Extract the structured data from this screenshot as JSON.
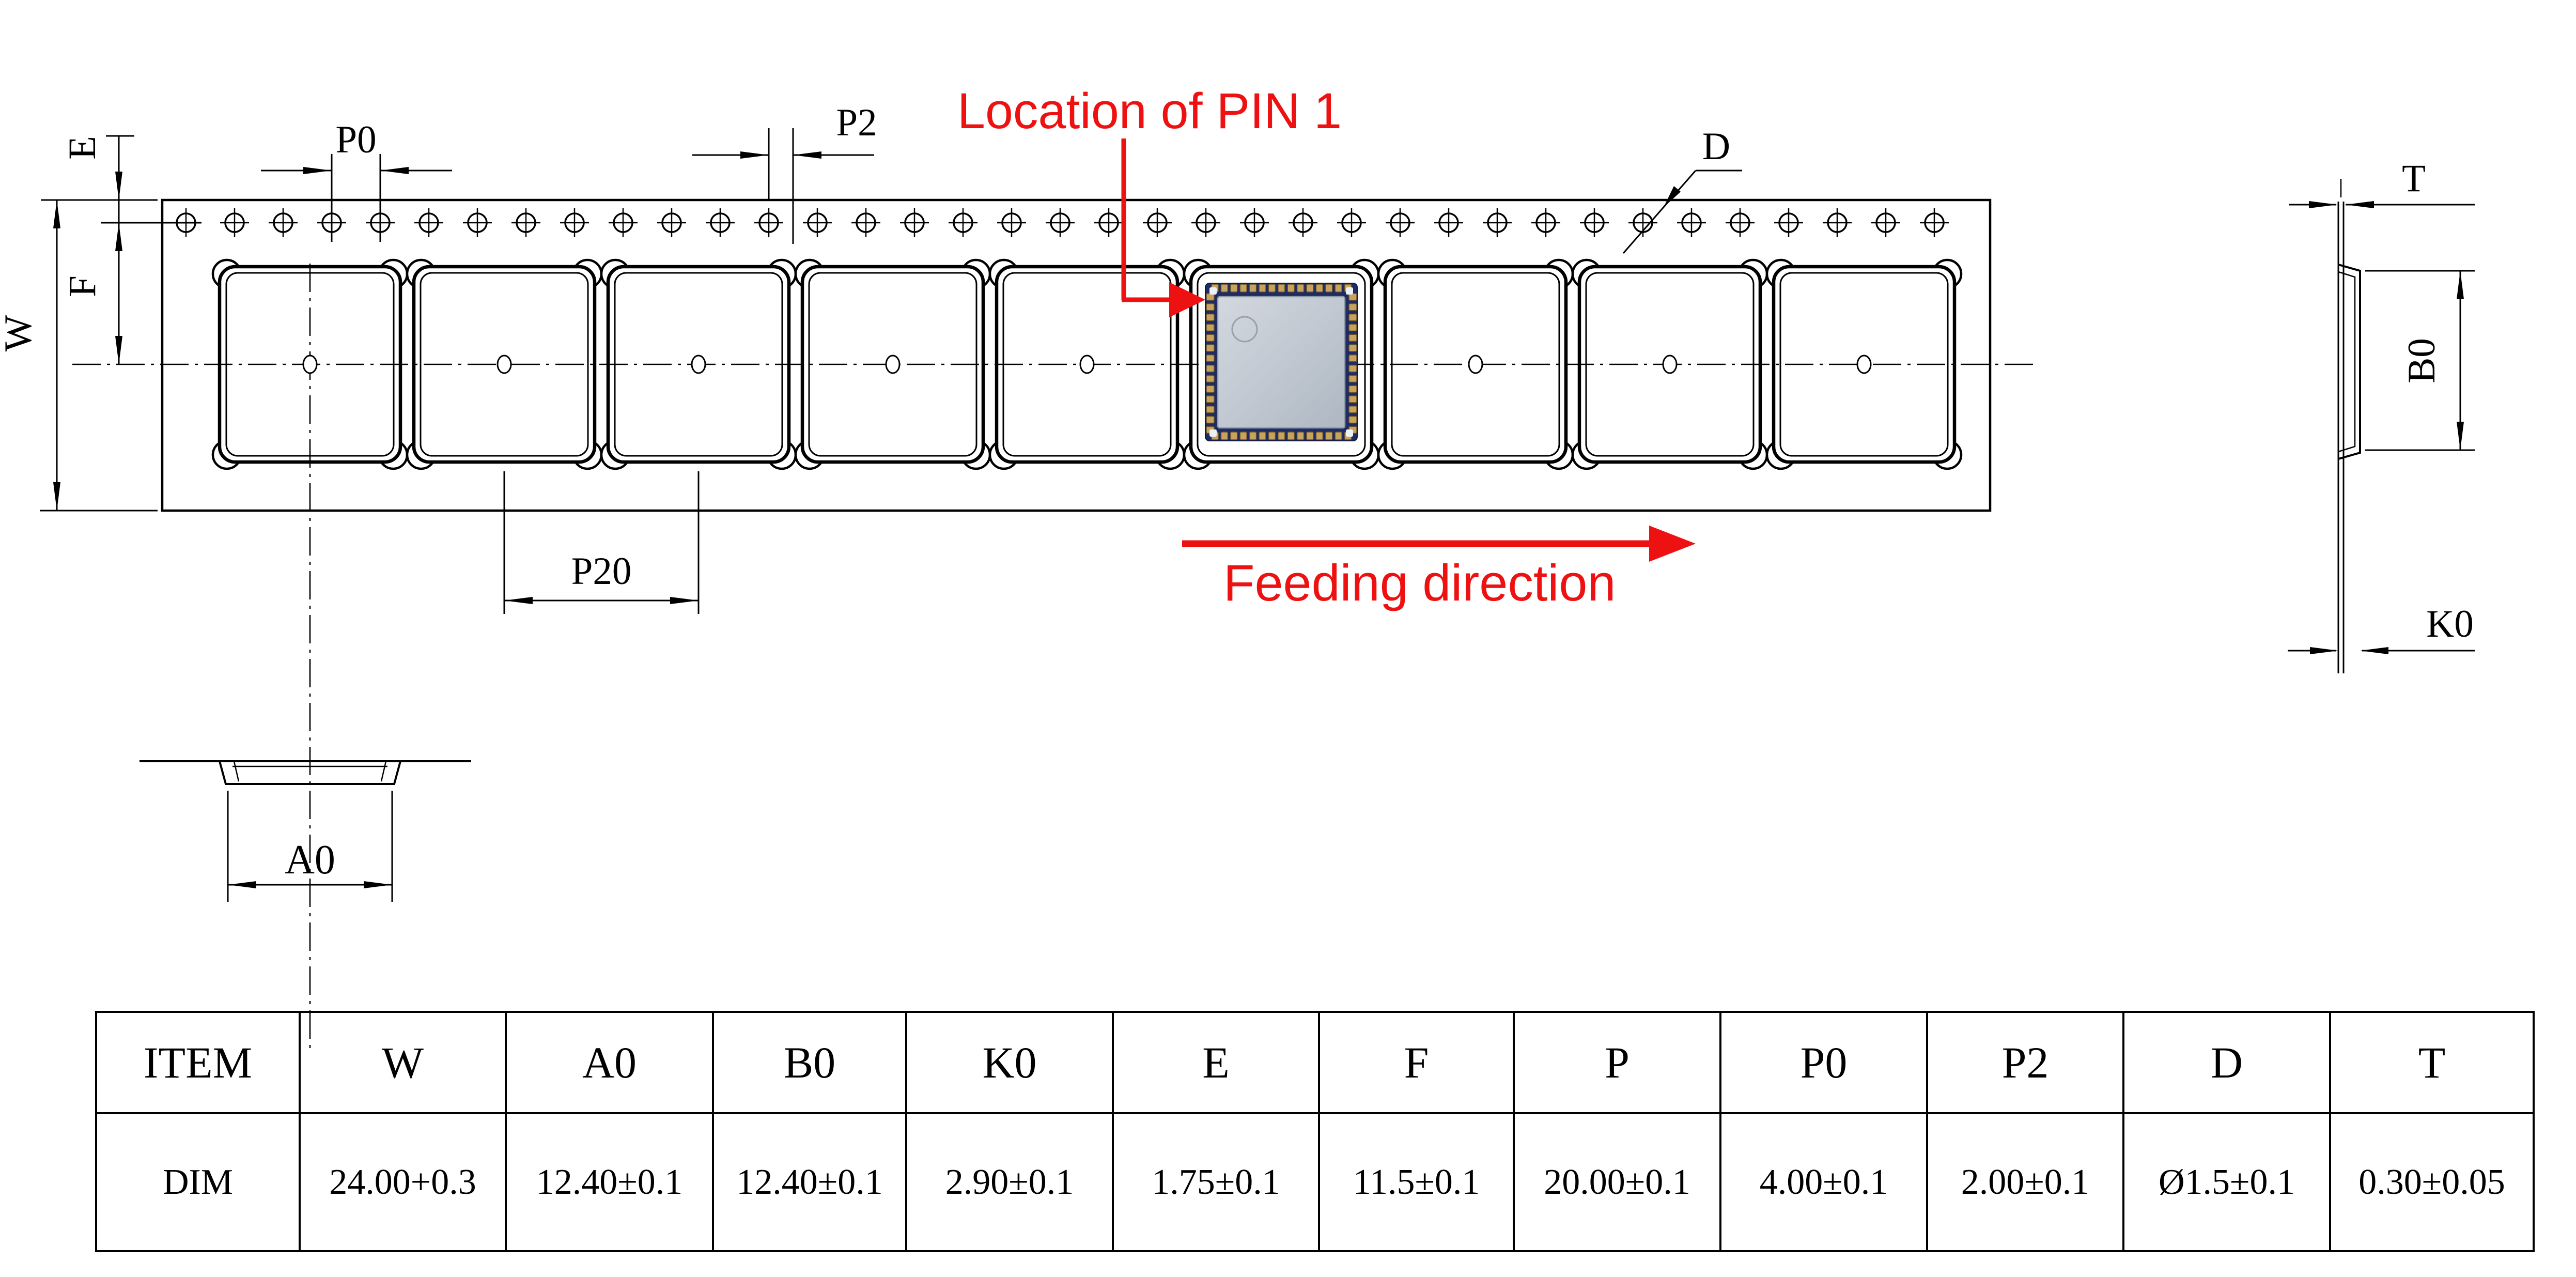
{
  "drawing": {
    "annotations": {
      "pin1_label": "Location of PIN 1",
      "feeding_label": "Feeding direction"
    },
    "dim_labels": {
      "e": "E",
      "f": "F",
      "w": "W",
      "p0": "P0",
      "p2": "P2",
      "p20": "P20",
      "a0": "A0",
      "b0": "B0",
      "k0": "K0",
      "t": "T",
      "d": "D"
    },
    "colors": {
      "annotation_red": "#ee1111",
      "line_black": "#000000",
      "module_pcb": "#1e2c63",
      "module_shield": "#c3cad3",
      "module_pins": "#c7a35f"
    }
  },
  "table": {
    "headers": [
      "ITEM",
      "W",
      "A0",
      "B0",
      "K0",
      "E",
      "F",
      "P",
      "P0",
      "P2",
      "D",
      "T"
    ],
    "rows": [
      [
        "DIM",
        "24.00+0.3",
        "12.40±0.1",
        "12.40±0.1",
        "2.90±0.1",
        "1.75±0.1",
        "11.5±0.1",
        "20.00±0.1",
        "4.00±0.1",
        "2.00±0.1",
        "Ø1.5±0.1",
        "0.30±0.05"
      ]
    ]
  }
}
